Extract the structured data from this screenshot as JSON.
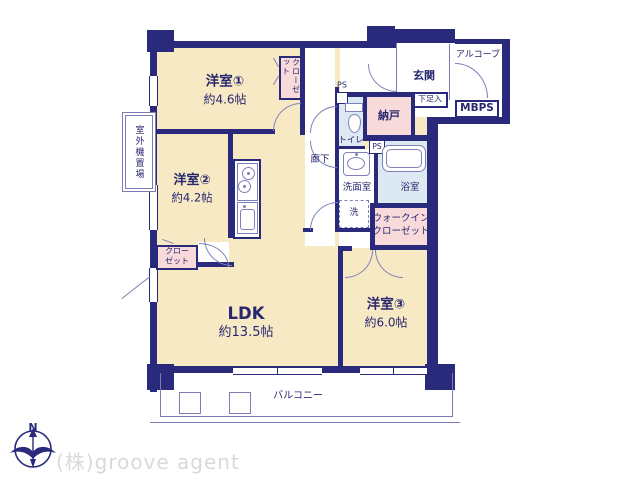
{
  "colors": {
    "wall": "#2a2a7c",
    "line": "#8080b8",
    "thin": "#7d7db6",
    "ink": "#28286f",
    "cream": "#f8e9c5",
    "pink": "#f8dada",
    "blue": "#dce9f2",
    "watermark": "#d9d9d9",
    "bg": "#ffffff"
  },
  "compass": {
    "north_label": "N"
  },
  "watermark": {
    "text": "(株)groove agent"
  },
  "floorplan": {
    "rooms": {
      "western1": {
        "name": "洋室①",
        "area": "約4.6帖"
      },
      "western2": {
        "name": "洋室②",
        "area": "約4.2帖"
      },
      "western3": {
        "name": "洋室③",
        "area": "約6.0帖"
      },
      "ldk": {
        "name": "LDK",
        "area": "約13.5帖"
      },
      "entrance": {
        "label": "玄関"
      },
      "alcove": {
        "label": "アルコーブ"
      },
      "storage": {
        "label": "納戸"
      },
      "shoe_box": {
        "label": "下足入"
      },
      "mbps": {
        "label": "MBPS"
      },
      "toilet": {
        "label": "トイレ"
      },
      "pipe_space_1": {
        "label": "PS"
      },
      "pipe_space_2": {
        "label": "PS"
      },
      "hallway": {
        "label": "廊下"
      },
      "washroom": {
        "label": "洗面室"
      },
      "laundry": {
        "label": "洗"
      },
      "bathroom": {
        "label": "浴室"
      },
      "walk_in_closet": {
        "line1": "ウォークイン",
        "line2": "クローゼット"
      },
      "closet_1": {
        "label": "クローゼット"
      },
      "closet_2": {
        "line1": "クロー",
        "line2": "ゼット"
      },
      "balcony": {
        "label": "バルコニー"
      },
      "outdoor_unit": {
        "label": "室外機置場"
      }
    }
  }
}
